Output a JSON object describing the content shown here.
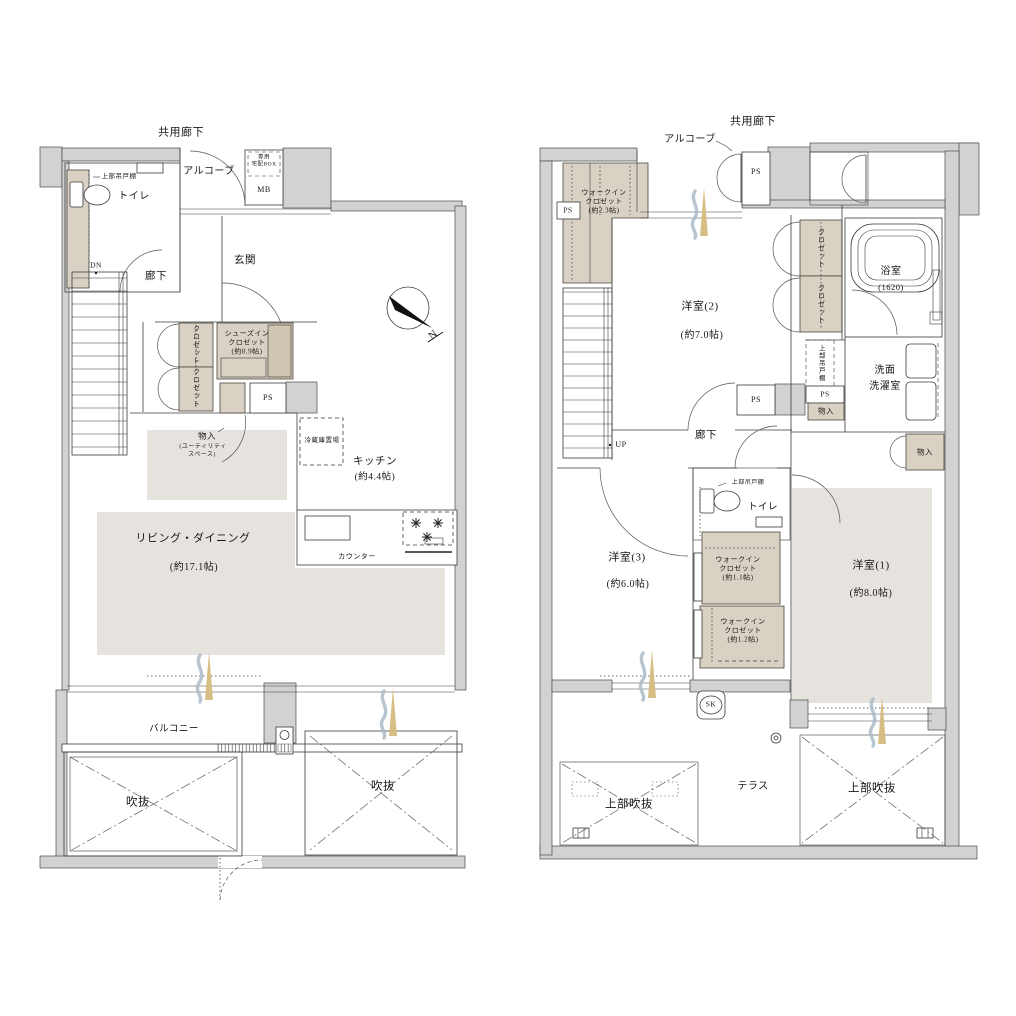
{
  "colors": {
    "wall": "#d2d2d2",
    "wall_edge": "#4a4a4a",
    "tan": "#d9d2c4",
    "tan_dark": "#cfc6b4",
    "shade": "#e6e3de",
    "line": "#3b3b3b",
    "gold": "#d5ba7d",
    "blue": "#a9bbc8"
  },
  "common": {
    "kyoyo_roka": "共用廊下",
    "alcove": "アルコーブ",
    "toilet": "トイレ",
    "roka": "廊下",
    "ps": "PS",
    "closet": "クロゼット",
    "monoire": "物入",
    "jobu_tsuridana": "上部吊戸棚",
    "fukinuke": "吹抜",
    "jobu_fukinuke": "上部吹抜",
    "walkin1": "ウォークイン",
    "walkin2": "クロゼット"
  },
  "f1": {
    "takuhai1": "専用",
    "takuhai2": "宅配BOX",
    "mb": "MB",
    "genkan": "玄関",
    "dn": "DN",
    "shoes1": "シューズイン",
    "shoes2": "クロゼット",
    "shoes3": "(約0.9帖)",
    "monoire_sub1": "(ユーティリティ",
    "monoire_sub2": "スペース)",
    "reizoko": "冷蔵庫置場",
    "kitchen": "キッチン",
    "kitchen_size": "(約4.4帖)",
    "counter": "カウンター",
    "living": "リビング・ダイニング",
    "living_size": "(約17.1帖)",
    "balcony": "バルコニー",
    "north": "N"
  },
  "f2": {
    "wic23_size": "(約2.3帖)",
    "yoshitsu2": "洋室(2)",
    "yoshitsu2_size": "(約7.0帖)",
    "bath": "浴室",
    "bath_size": "(1620)",
    "senmen1": "洗面",
    "senmen2": "洗濯室",
    "up": "UP",
    "yoshitsu3": "洋室(3)",
    "yoshitsu3_size": "(約6.0帖)",
    "wic11_size": "(約1.1帖)",
    "wic12_size": "(約1.2帖)",
    "yoshitsu1": "洋室(1)",
    "yoshitsu1_size": "(約8.0帖)",
    "sk": "SK",
    "terrace": "テラス"
  }
}
